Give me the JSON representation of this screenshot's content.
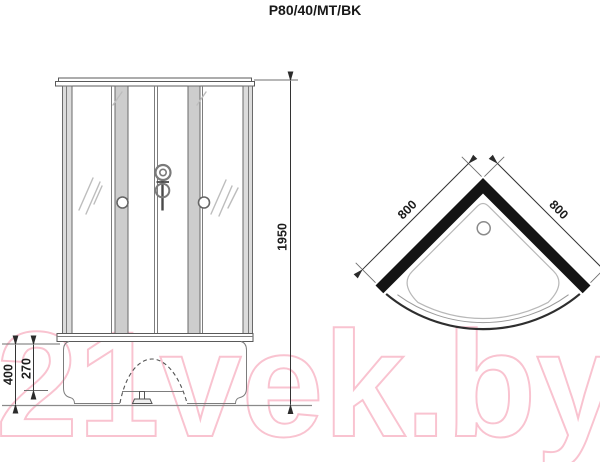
{
  "title": "P80/40/MT/BK",
  "watermark": "21vek.by",
  "front_view": {
    "dim_height": "1950",
    "dim_base_height": "400",
    "dim_tray_height": "270"
  },
  "top_view": {
    "dim_side_left": "800",
    "dim_side_right": "800"
  },
  "colors": {
    "wall_black": "#141414",
    "panel_gray": "#cdcdcd",
    "watermark_pink": "#f9c3d0"
  }
}
